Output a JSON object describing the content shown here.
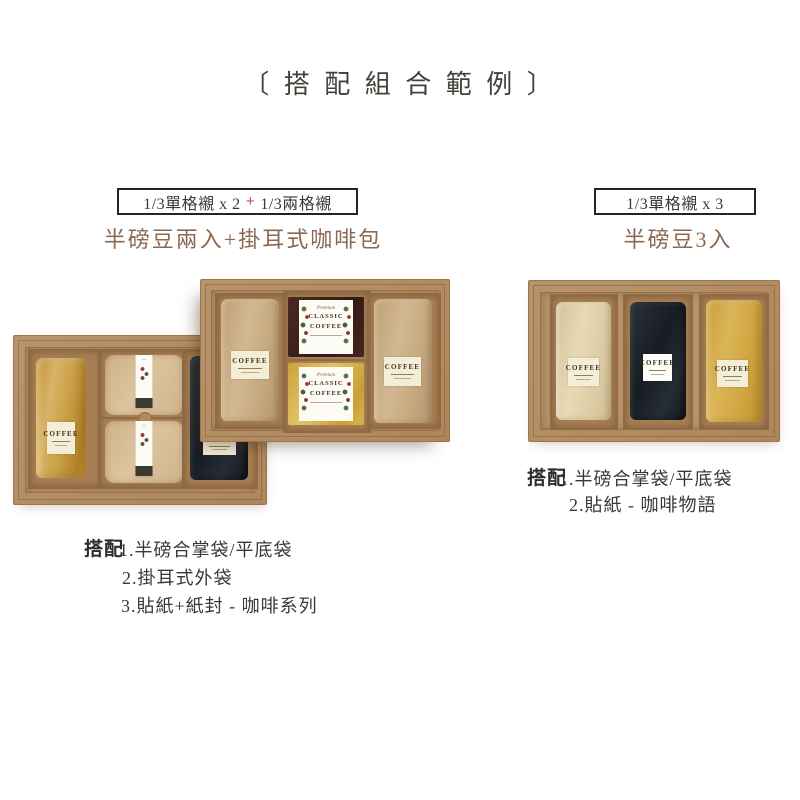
{
  "title": "〔 搭 配 組 合 範 例 〕",
  "left_combo": {
    "badge_part1": "1/3單格襯 x 2",
    "badge_plus": "+",
    "badge_part2": "1/3兩格襯",
    "subtitle": "半磅豆兩入+掛耳式咖啡包",
    "pairing_label": "搭配",
    "pairing_items": [
      "1.半磅合掌袋/平底袋",
      "2.掛耳式外袋",
      "3.貼紙+紙封 - 咖啡系列"
    ]
  },
  "right_combo": {
    "badge": "1/3單格襯 x 3",
    "subtitle": "半磅豆3入",
    "pairing_label": "搭配",
    "pairing_items": [
      "1.半磅合掌袋/平底袋",
      "2.貼紙 - 咖啡物語"
    ]
  },
  "product_labels": {
    "coffee": "COFFEE",
    "premium": "Premium",
    "classic_line1": "CLASSIC",
    "classic_line2": "COFFEE"
  },
  "colors": {
    "plus_accent": "#c4525a",
    "subtitle_brown": "#8b6852",
    "kraft_box": "#b18b5f",
    "gold_bag": "#c99c3e",
    "black_bag": "#22282e",
    "cream_label": "#f5eed7"
  }
}
